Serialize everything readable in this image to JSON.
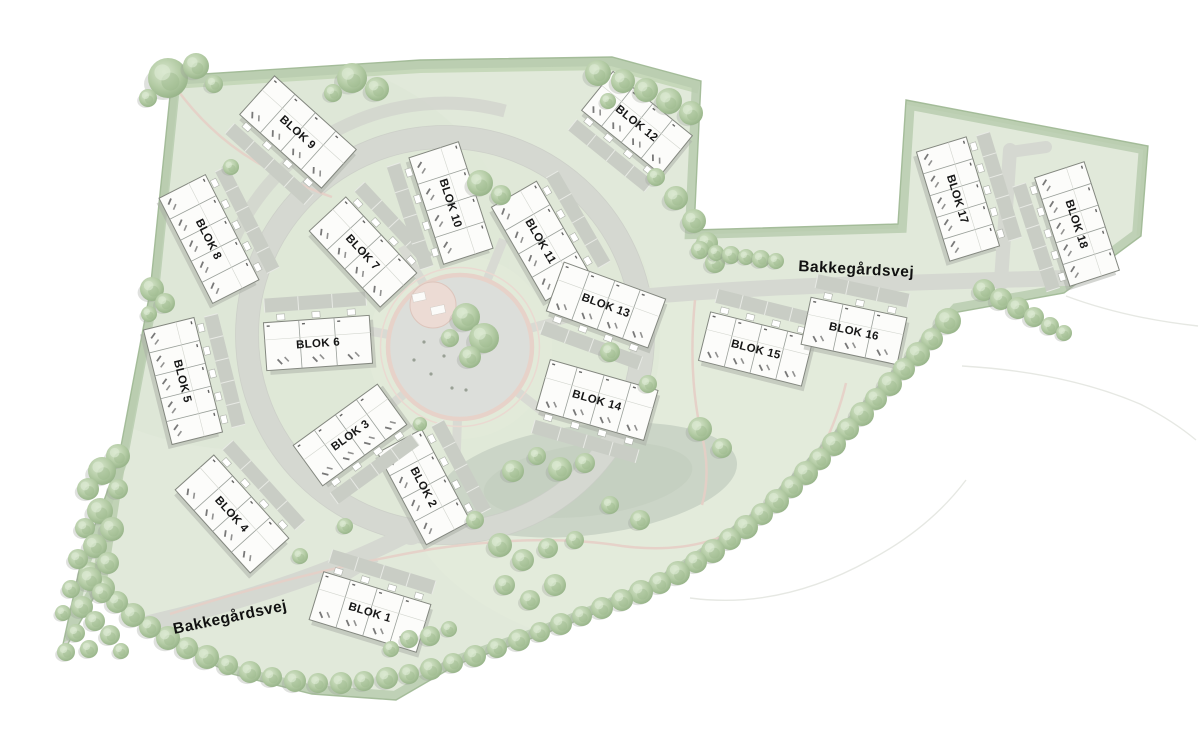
{
  "map": {
    "type": "residential-site-plan",
    "street_labels": [
      {
        "name": "Bakkegårdsvej",
        "x": 231,
        "y": 622,
        "rotation": -12,
        "font_size": 15.5
      },
      {
        "name": "Bakkegårdsvej",
        "x": 856,
        "y": 274,
        "rotation": 3,
        "font_size": 15.5
      }
    ],
    "blocks": [
      {
        "label": "BLOK 1",
        "x": 370,
        "y": 612,
        "rotation": 17,
        "w": 112,
        "h": 50,
        "units": 4,
        "strip": -1
      },
      {
        "label": "BLOK 2",
        "x": 424,
        "y": 487,
        "rotation": 62,
        "w": 104,
        "h": 50,
        "units": 4,
        "strip": -1
      },
      {
        "label": "BLOK 3",
        "x": 350,
        "y": 435,
        "rotation": -36,
        "w": 104,
        "h": 50,
        "units": 4,
        "strip": 1
      },
      {
        "label": "BLOK 4",
        "x": 232,
        "y": 514,
        "rotation": 48,
        "w": 112,
        "h": 52,
        "units": 4,
        "strip": -1
      },
      {
        "label": "BLOK 5",
        "x": 183,
        "y": 381,
        "rotation": 76,
        "w": 118,
        "h": 52,
        "units": 5,
        "strip": -1
      },
      {
        "label": "BLOK 6",
        "x": 318,
        "y": 343,
        "rotation": -4,
        "w": 106,
        "h": 48,
        "units": 3,
        "strip": -1
      },
      {
        "label": "BLOK 7",
        "x": 363,
        "y": 252,
        "rotation": 47,
        "w": 104,
        "h": 50,
        "units": 4,
        "strip": -1
      },
      {
        "label": "BLOK 8",
        "x": 209,
        "y": 239,
        "rotation": 63,
        "w": 118,
        "h": 52,
        "units": 5,
        "strip": -1
      },
      {
        "label": "BLOK 9",
        "x": 298,
        "y": 132,
        "rotation": 42,
        "w": 110,
        "h": 52,
        "units": 4,
        "strip": 1
      },
      {
        "label": "BLOK 10",
        "x": 451,
        "y": 203,
        "rotation": 72,
        "w": 112,
        "h": 52,
        "units": 4,
        "strip": 1
      },
      {
        "label": "BLOK 11",
        "x": 541,
        "y": 241,
        "rotation": 60,
        "w": 108,
        "h": 52,
        "units": 4,
        "strip": -1
      },
      {
        "label": "BLOK 12",
        "x": 637,
        "y": 123,
        "rotation": 39,
        "w": 102,
        "h": 50,
        "units": 4,
        "strip": 1
      },
      {
        "label": "BLOK 13",
        "x": 606,
        "y": 305,
        "rotation": 20,
        "w": 108,
        "h": 52,
        "units": 4,
        "strip": 1
      },
      {
        "label": "BLOK 14",
        "x": 597,
        "y": 400,
        "rotation": 16,
        "w": 112,
        "h": 52,
        "units": 4,
        "strip": 1
      },
      {
        "label": "BLOK 15",
        "x": 756,
        "y": 349,
        "rotation": 14,
        "w": 106,
        "h": 50,
        "units": 4,
        "strip": -1
      },
      {
        "label": "BLOK 16",
        "x": 854,
        "y": 331,
        "rotation": 12,
        "w": 98,
        "h": 48,
        "units": 3,
        "strip": -1
      },
      {
        "label": "BLOK 17",
        "x": 958,
        "y": 199,
        "rotation": 73,
        "w": 114,
        "h": 52,
        "units": 5,
        "strip": -1
      },
      {
        "label": "BLOK 18",
        "x": 1077,
        "y": 224,
        "rotation": 72,
        "w": 114,
        "h": 52,
        "units": 5,
        "strip": 1
      }
    ],
    "colors": {
      "site": "#e1e9da",
      "site_edge": "#b9cdaf",
      "site_outline": "#9fb894",
      "hedge": "#c6d8ba",
      "road": "#d5d8d1",
      "road_edge": "#c9ccc5",
      "apron": "#c9cdc5",
      "building": "#fcfcfa",
      "building_stroke": "#83877f",
      "divider": "#9aa09a",
      "shadow": "#a9ada5",
      "plaza_paving": "#dcdeda",
      "plaza_ring": "#e7d2c9",
      "pink_fill": "#ecdbd4",
      "pink_path": "#e6cfc6",
      "pond": "#cbd5c7",
      "pond_inner": "#c4cfc0",
      "label": "#161616",
      "gray_path": "#d8dad3",
      "tree_dark": "#8fad81",
      "tree_mid": "#b3cba4",
      "tree_light": "#d9e7ce"
    }
  }
}
